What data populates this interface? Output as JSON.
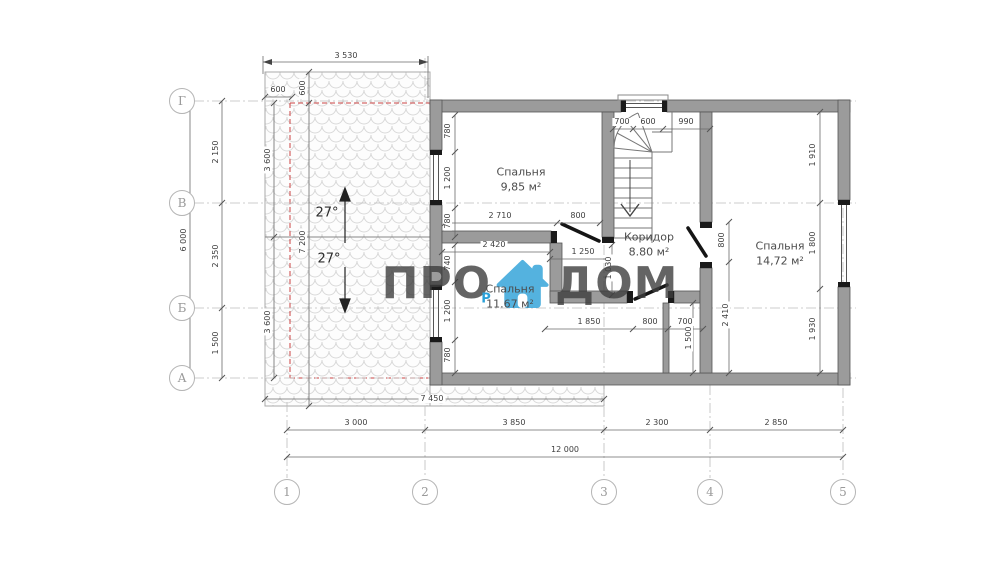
{
  "watermark": {
    "left": "ПРО",
    "right": "ДОМ",
    "sub": "Р",
    "icon": "house-icon",
    "accent_color": "#2aa0d8",
    "text_color": "#3e3e3e"
  },
  "axes": {
    "rows": [
      {
        "label": "Г",
        "y": 101
      },
      {
        "label": "В",
        "y": 203
      },
      {
        "label": "Б",
        "y": 308
      },
      {
        "label": "А",
        "y": 378
      }
    ],
    "cols": [
      {
        "label": "1",
        "x": 287
      },
      {
        "label": "2",
        "x": 425
      },
      {
        "label": "3",
        "x": 604
      },
      {
        "label": "4",
        "x": 710
      },
      {
        "label": "5",
        "x": 843
      }
    ]
  },
  "rooms": [
    {
      "name": "Спальня",
      "area": "9,85 м²",
      "x": 521,
      "y": 180
    },
    {
      "name": "Коридор",
      "area": "8.80 м²",
      "x": 649,
      "y": 245
    },
    {
      "name": "Спальня",
      "area": "14,72 м²",
      "x": 780,
      "y": 254
    },
    {
      "name": "Спальня",
      "area": "11.67 м²",
      "x": 510,
      "y": 297
    }
  ],
  "dimensions": [
    {
      "t": "3 530",
      "x": 346,
      "y": 56
    },
    {
      "t": "600",
      "x": 278,
      "y": 90
    },
    {
      "t": "600",
      "x": 303,
      "y": 88,
      "rot": true
    },
    {
      "t": "6 000",
      "x": 184,
      "y": 240,
      "rot": true
    },
    {
      "t": "2 150",
      "x": 216,
      "y": 152,
      "rot": true
    },
    {
      "t": "2 350",
      "x": 216,
      "y": 256,
      "rot": true
    },
    {
      "t": "1 500",
      "x": 216,
      "y": 343,
      "rot": true
    },
    {
      "t": "3 600",
      "x": 268,
      "y": 160,
      "rot": true
    },
    {
      "t": "3 600",
      "x": 268,
      "y": 322,
      "rot": true
    },
    {
      "t": "7 200",
      "x": 303,
      "y": 242,
      "rot": true
    },
    {
      "t": "27°",
      "x": 327,
      "y": 213,
      "angle": true
    },
    {
      "t": "27°",
      "x": 329,
      "y": 259,
      "angle": true
    },
    {
      "t": "7 450",
      "x": 432,
      "y": 399
    },
    {
      "t": "3 000",
      "x": 356,
      "y": 423
    },
    {
      "t": "3 850",
      "x": 514,
      "y": 423
    },
    {
      "t": "2 300",
      "x": 657,
      "y": 423
    },
    {
      "t": "2 850",
      "x": 776,
      "y": 423
    },
    {
      "t": "12 000",
      "x": 565,
      "y": 450
    },
    {
      "t": "780",
      "x": 448,
      "y": 131,
      "rot": true
    },
    {
      "t": "1 200",
      "x": 448,
      "y": 178,
      "rot": true
    },
    {
      "t": "780",
      "x": 448,
      "y": 221,
      "rot": true
    },
    {
      "t": "2 710",
      "x": 500,
      "y": 216
    },
    {
      "t": "800",
      "x": 578,
      "y": 216
    },
    {
      "t": "700",
      "x": 622,
      "y": 122
    },
    {
      "t": "600",
      "x": 648,
      "y": 122
    },
    {
      "t": "990",
      "x": 686,
      "y": 122
    },
    {
      "t": "1 250",
      "x": 583,
      "y": 252
    },
    {
      "t": "1 030",
      "x": 609,
      "y": 268,
      "rot": true
    },
    {
      "t": "2 420",
      "x": 494,
      "y": 245
    },
    {
      "t": "740",
      "x": 448,
      "y": 263,
      "rot": true
    },
    {
      "t": "1 200",
      "x": 448,
      "y": 311,
      "rot": true
    },
    {
      "t": "780",
      "x": 448,
      "y": 355,
      "rot": true
    },
    {
      "t": "1 850",
      "x": 589,
      "y": 322
    },
    {
      "t": "800",
      "x": 650,
      "y": 322
    },
    {
      "t": "700",
      "x": 685,
      "y": 322
    },
    {
      "t": "1 500",
      "x": 689,
      "y": 338,
      "rot": true
    },
    {
      "t": "800",
      "x": 722,
      "y": 240,
      "rot": true
    },
    {
      "t": "2 410",
      "x": 726,
      "y": 315,
      "rot": true
    },
    {
      "t": "1 910",
      "x": 813,
      "y": 155,
      "rot": true
    },
    {
      "t": "1 800",
      "x": 813,
      "y": 243,
      "rot": true
    },
    {
      "t": "1 930",
      "x": 813,
      "y": 329,
      "rot": true
    }
  ]
}
